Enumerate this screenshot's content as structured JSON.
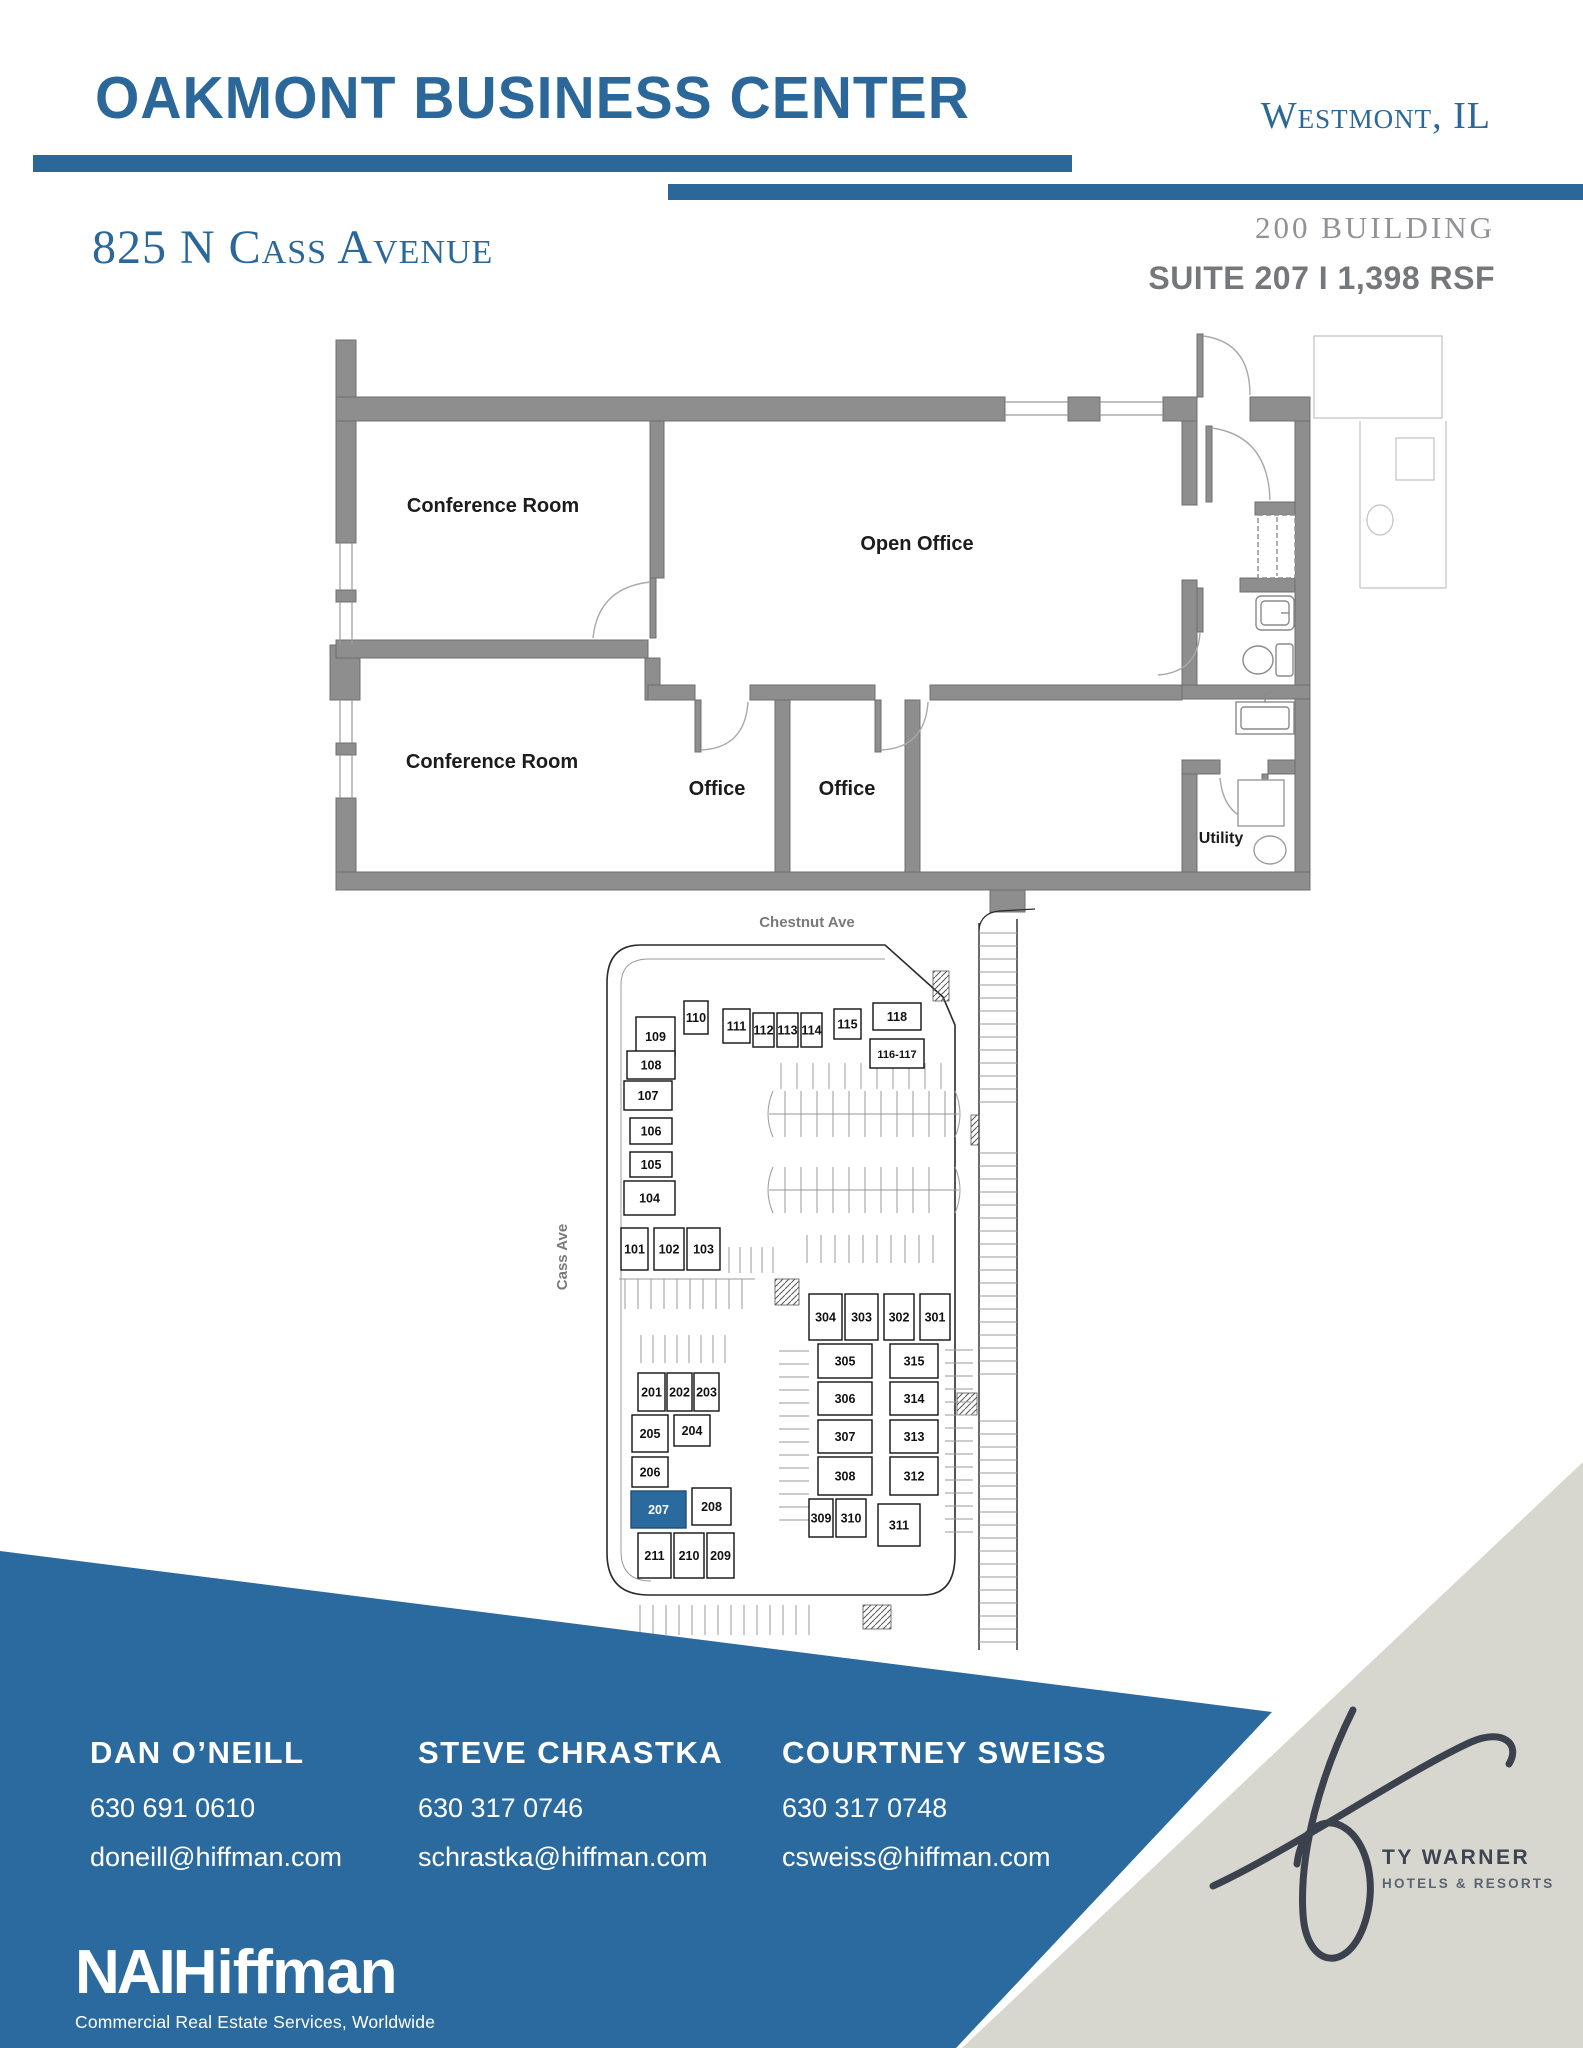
{
  "header": {
    "title": "OAKMONT BUSINESS CENTER",
    "location": "Westmont, IL",
    "building": "200 BUILDING",
    "suite_line": "SUITE 207  I  1,398 RSF"
  },
  "address": "825 N Cass Avenue",
  "colors": {
    "accent_blue": "#2b6899",
    "band_blue": "#2b6a9e",
    "unit_highlight": "#2b6a9e",
    "beige": "#d8d7cf",
    "wall_gray": "#8e8e8e",
    "text_gray": "#76777a"
  },
  "floor_plan": {
    "rooms": [
      {
        "label": "Conference Room",
        "x": 193,
        "y": 192,
        "size": 20
      },
      {
        "label": "Open Office",
        "x": 617,
        "y": 230,
        "size": 20
      },
      {
        "label": "Conference Room",
        "x": 192,
        "y": 448,
        "size": 20
      },
      {
        "label": "Office",
        "x": 417,
        "y": 475,
        "size": 20
      },
      {
        "label": "Office",
        "x": 547,
        "y": 475,
        "size": 20
      },
      {
        "label": "Utility",
        "x": 921,
        "y": 523,
        "size": 16
      }
    ]
  },
  "site_plan": {
    "streets": {
      "top": "Chestnut Ave",
      "left": "Cass Ave"
    },
    "highlighted_unit": "207",
    "buildings": [
      {
        "name": "100 Building",
        "units": [
          {
            "label": "109",
            "x": 91,
            "y": 112,
            "w": 39,
            "h": 39
          },
          {
            "label": "110",
            "x": 139,
            "y": 96,
            "w": 24,
            "h": 33
          },
          {
            "label": "111",
            "x": 178,
            "y": 104,
            "w": 27,
            "h": 34
          },
          {
            "label": "112",
            "x": 208,
            "y": 108,
            "w": 21,
            "h": 34
          },
          {
            "label": "113",
            "x": 232,
            "y": 108,
            "w": 21,
            "h": 34
          },
          {
            "label": "114",
            "x": 256,
            "y": 108,
            "w": 21,
            "h": 34
          },
          {
            "label": "115",
            "x": 289,
            "y": 104,
            "w": 27,
            "h": 30
          },
          {
            "label": "118",
            "x": 328,
            "y": 98,
            "w": 48,
            "h": 27
          },
          {
            "label": "116-117",
            "x": 325,
            "y": 134,
            "w": 54,
            "h": 29
          },
          {
            "label": "108",
            "x": 82,
            "y": 146,
            "w": 48,
            "h": 28
          },
          {
            "label": "107",
            "x": 79,
            "y": 176,
            "w": 48,
            "h": 29
          },
          {
            "label": "106",
            "x": 85,
            "y": 213,
            "w": 42,
            "h": 26
          },
          {
            "label": "105",
            "x": 85,
            "y": 247,
            "w": 42,
            "h": 25
          },
          {
            "label": "104",
            "x": 79,
            "y": 276,
            "w": 51,
            "h": 34
          },
          {
            "label": "101",
            "x": 76,
            "y": 323,
            "w": 27,
            "h": 42
          },
          {
            "label": "102",
            "x": 109,
            "y": 323,
            "w": 30,
            "h": 42
          },
          {
            "label": "103",
            "x": 142,
            "y": 323,
            "w": 33,
            "h": 42
          }
        ]
      },
      {
        "name": "200 Building",
        "units": [
          {
            "label": "201",
            "x": 93,
            "y": 468,
            "w": 27,
            "h": 38
          },
          {
            "label": "202",
            "x": 122,
            "y": 468,
            "w": 25,
            "h": 38
          },
          {
            "label": "203",
            "x": 149,
            "y": 468,
            "w": 25,
            "h": 38
          },
          {
            "label": "205",
            "x": 87,
            "y": 510,
            "w": 36,
            "h": 37
          },
          {
            "label": "204",
            "x": 129,
            "y": 510,
            "w": 36,
            "h": 31
          },
          {
            "label": "206",
            "x": 87,
            "y": 552,
            "w": 36,
            "h": 30
          },
          {
            "label": "207",
            "x": 86,
            "y": 586,
            "w": 55,
            "h": 37,
            "highlight": true
          },
          {
            "label": "208",
            "x": 147,
            "y": 583,
            "w": 39,
            "h": 37
          },
          {
            "label": "211",
            "x": 93,
            "y": 628,
            "w": 33,
            "h": 45
          },
          {
            "label": "210",
            "x": 129,
            "y": 628,
            "w": 30,
            "h": 45
          },
          {
            "label": "209",
            "x": 162,
            "y": 628,
            "w": 27,
            "h": 45
          }
        ]
      },
      {
        "name": "300 Building",
        "units": [
          {
            "label": "304",
            "x": 264,
            "y": 389,
            "w": 33,
            "h": 46
          },
          {
            "label": "303",
            "x": 300,
            "y": 389,
            "w": 33,
            "h": 46
          },
          {
            "label": "302",
            "x": 339,
            "y": 389,
            "w": 30,
            "h": 46
          },
          {
            "label": "301",
            "x": 375,
            "y": 389,
            "w": 30,
            "h": 46
          },
          {
            "label": "305",
            "x": 273,
            "y": 439,
            "w": 54,
            "h": 34
          },
          {
            "label": "315",
            "x": 345,
            "y": 439,
            "w": 48,
            "h": 34
          },
          {
            "label": "306",
            "x": 273,
            "y": 477,
            "w": 54,
            "h": 33
          },
          {
            "label": "314",
            "x": 345,
            "y": 477,
            "w": 48,
            "h": 33
          },
          {
            "label": "307",
            "x": 273,
            "y": 515,
            "w": 54,
            "h": 33
          },
          {
            "label": "313",
            "x": 345,
            "y": 515,
            "w": 48,
            "h": 33
          },
          {
            "label": "308",
            "x": 273,
            "y": 552,
            "w": 54,
            "h": 38
          },
          {
            "label": "312",
            "x": 345,
            "y": 552,
            "w": 48,
            "h": 38
          },
          {
            "label": "309",
            "x": 264,
            "y": 594,
            "w": 24,
            "h": 38
          },
          {
            "label": "310",
            "x": 291,
            "y": 594,
            "w": 30,
            "h": 38
          },
          {
            "label": "311",
            "x": 333,
            "y": 599,
            "w": 42,
            "h": 42
          }
        ]
      }
    ]
  },
  "contacts": [
    {
      "name": "DAN O’NEILL",
      "phone": "630 691 0610",
      "email": "doneill@hiffman.com"
    },
    {
      "name": "STEVE CHRASTKA",
      "phone": "630 317 0746",
      "email": "schrastka@hiffman.com"
    },
    {
      "name": "COURTNEY SWEISS",
      "phone": "630 317 0748",
      "email": "csweiss@hiffman.com"
    }
  ],
  "brokerage": {
    "logo_prefix": "NAI",
    "logo_suffix": "Hiffman",
    "tagline": "Commercial Real Estate Services, Worldwide"
  },
  "partner_logo": {
    "line1": "TY WARNER",
    "line2": "HOTELS & RESORTS"
  }
}
